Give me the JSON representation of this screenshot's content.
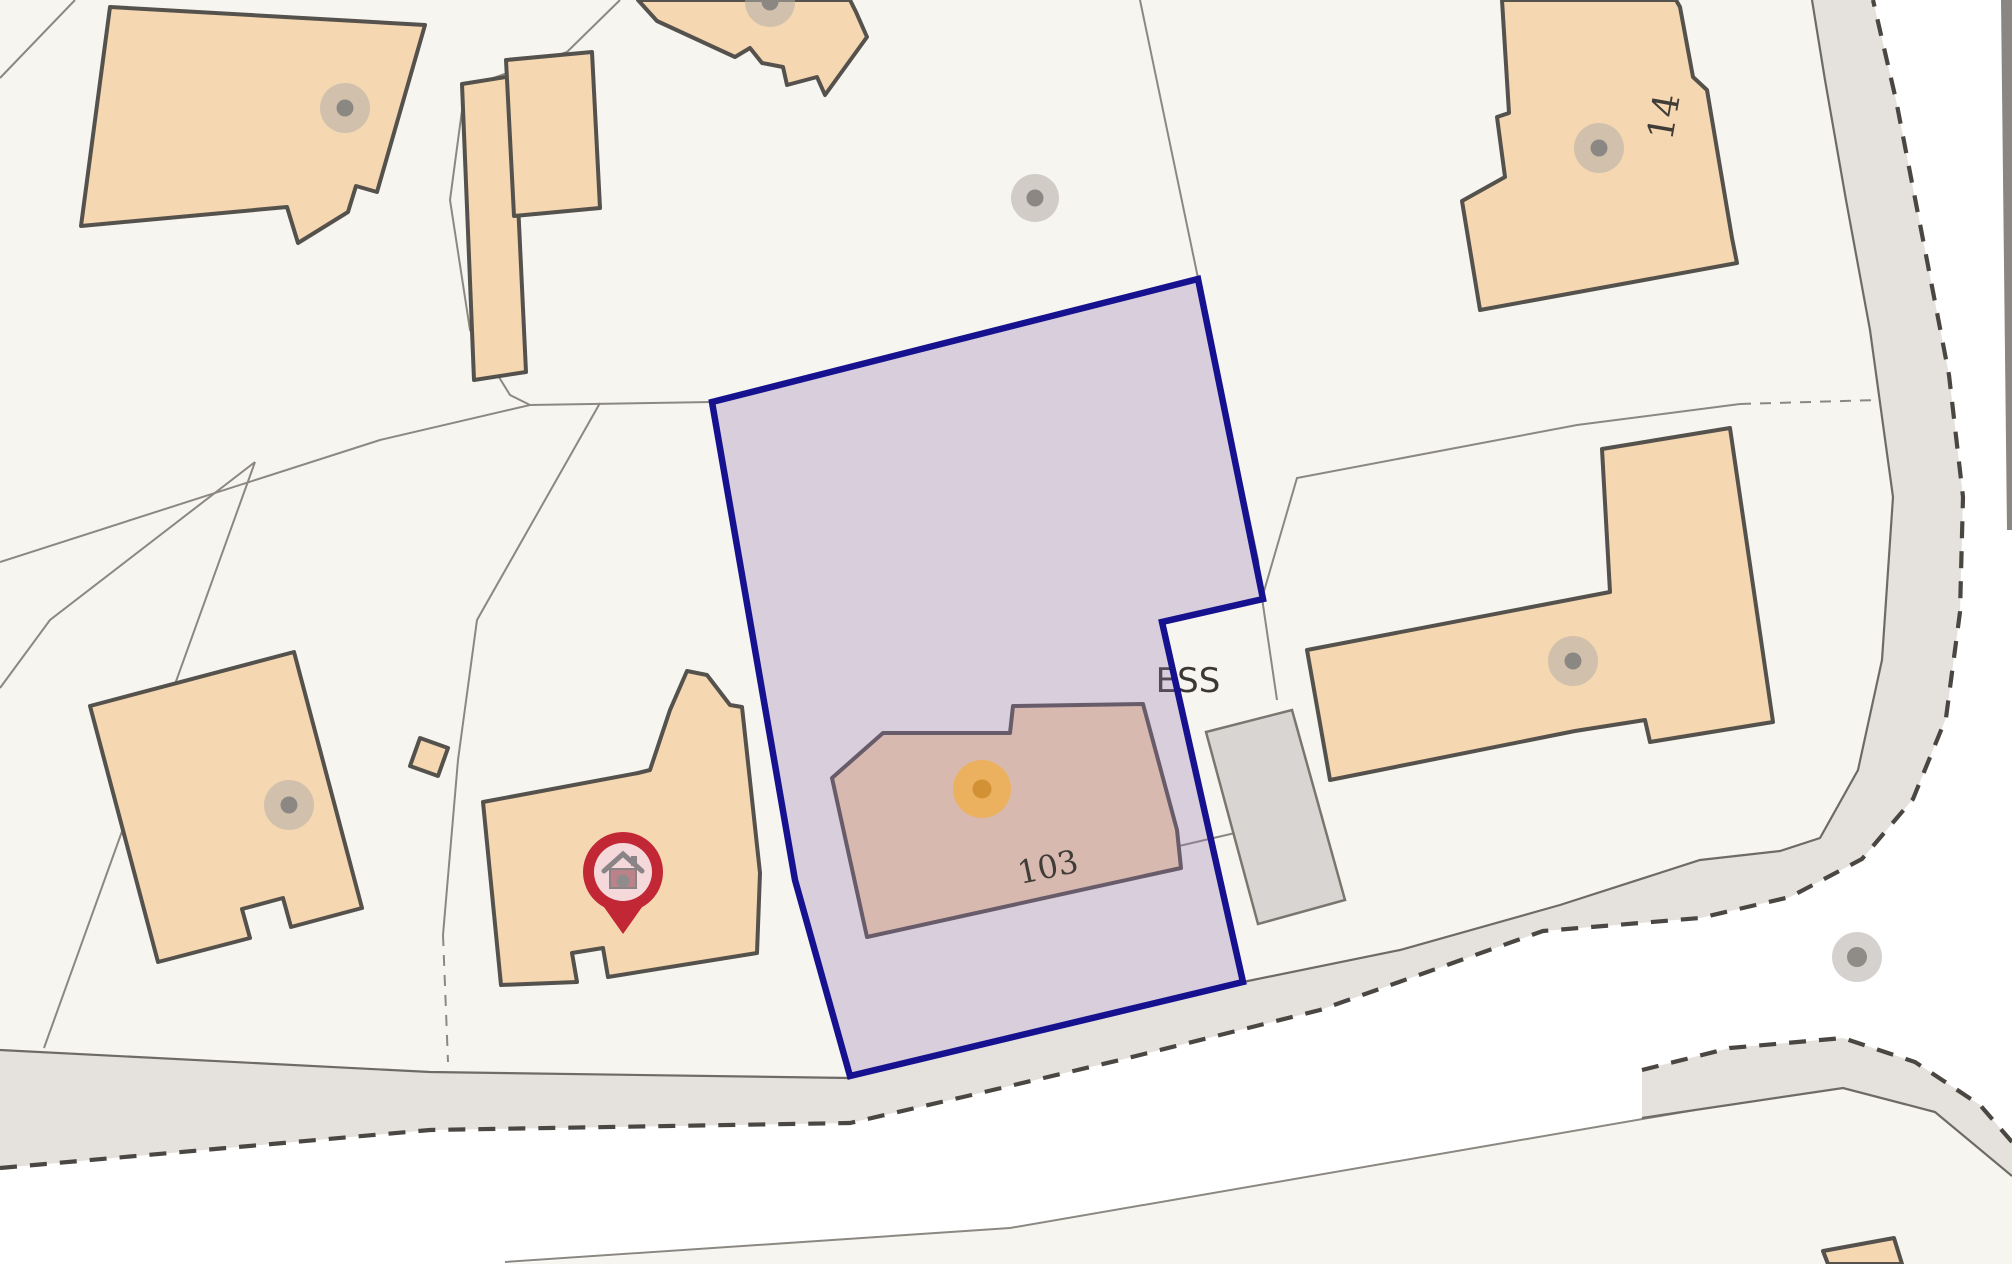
{
  "map": {
    "labels": {
      "plot_number": "103",
      "substation": "ESS",
      "house_number": "14"
    },
    "marker": {
      "icon": "home-pin-icon",
      "meaning": "property location marker"
    },
    "symbols": {
      "gray_dot": "feature-dot-icon",
      "orange_dot": "plot-centre-dot-icon"
    },
    "colors": {
      "plot_fill": "#9673ae",
      "plot_border": "#16128f",
      "building_fill": "#f5d7b1",
      "building_outline": "#55524d",
      "parcel_fill": "#f7f5f0",
      "parcel_line": "#8b8882",
      "road_fill": "#e5e1dd",
      "road_dash": "#4a4743",
      "gray_building_fill": "#d9d5d2",
      "pin_red": "#c12734",
      "orange_dot_inner": "#d19134",
      "orange_dot_outer": "#eeb057",
      "label_text": "#403c38"
    }
  }
}
